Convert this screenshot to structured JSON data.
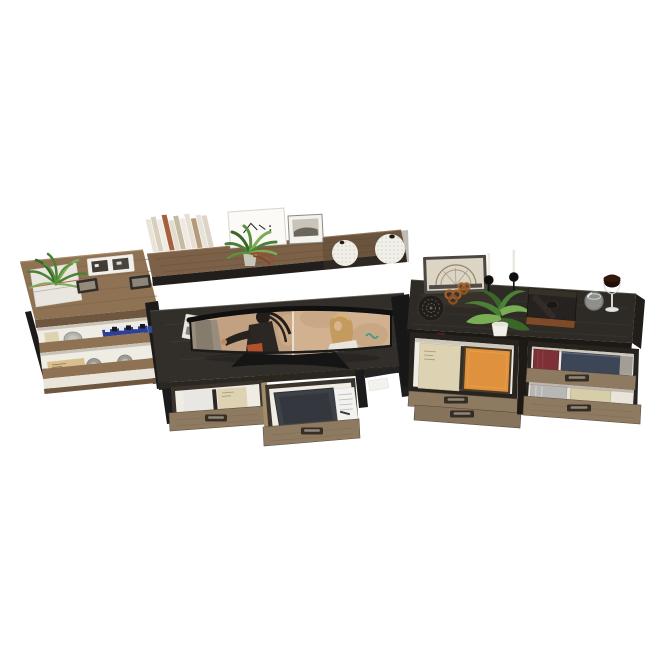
{
  "scene": {
    "type": "product-render",
    "subject": "Rustic wood and black metal home-office wall unit: ladder bookcase, desk with hutch shelf and curved ultrawide monitor, and a drawer media cabinet",
    "background": "#ffffff"
  },
  "palette": {
    "wood_rustic": "#8f7254",
    "wood_rustic_dark": "#6e563f",
    "wood_shelf": "#7c6148",
    "wood_drawer": "#8e7a61",
    "wood_drawer_dark": "#85735b",
    "desk_top": "#322e29",
    "cabinet_top": "#2e2a25",
    "metal_black": "#1b1b1b",
    "interior_light": "#efece4",
    "book_white": "#e8e7e3",
    "book_cream": "#ddd2b2",
    "book_tan": "#d9bf8e",
    "book_orange": "#e0913e",
    "book_red": "#7d3035",
    "book_navy": "#3d4656",
    "book_silver": "#b7b7b5",
    "book_beige": "#d8cda9",
    "box_blue": "#2e3f96",
    "plant_green": "#4c7f37",
    "plant_green_dark": "#3a662a",
    "plant_green_light": "#79ae55",
    "pot_white": "#f1efe8",
    "screen_tan_left": "#c2a183",
    "screen_tan_right": "#d1b190",
    "laptop_dark": "#3e4248",
    "copper": "#7e4a28"
  },
  "left_bookcase": {
    "top_items": [
      "spiky green plant on stack of white magazines",
      "two dark picture frames lying flat",
      "white double photo frame"
    ],
    "shelf_items": [
      "cream book",
      "round grey plate",
      "blue storage box with checkered trim",
      "tan book",
      "grey storage tins"
    ]
  },
  "hutch_shelf": {
    "items": [
      "row of leaning white and cream books",
      "green plant in glass pot",
      "white line-art frame",
      "grey landscape photo frame",
      "two white textured sphere vases"
    ]
  },
  "desk": {
    "monitor": "curved ultrawide monitor showing two outdoor portrait photos (man left, woman right)",
    "desk_items": [
      "white magazine on left corner"
    ],
    "drawers": [
      "open drawer with white and cream books",
      "pulled-out drawer with dark laptop, papers and pen"
    ]
  },
  "right_cabinet": {
    "top_items": [
      "leaning framed arch artwork",
      "two candlesticks with white candles",
      "black decor disc with pretzel ornaments",
      "green plant in white pot",
      "dark display box with copper base",
      "tumbler glass",
      "wine glass with dark drink"
    ],
    "cubby_items": [
      "cream book",
      "orange book",
      "red book",
      "navy book"
    ],
    "open_drawer_items": [
      "silver book",
      "beige book"
    ],
    "drawer_count": 5
  }
}
